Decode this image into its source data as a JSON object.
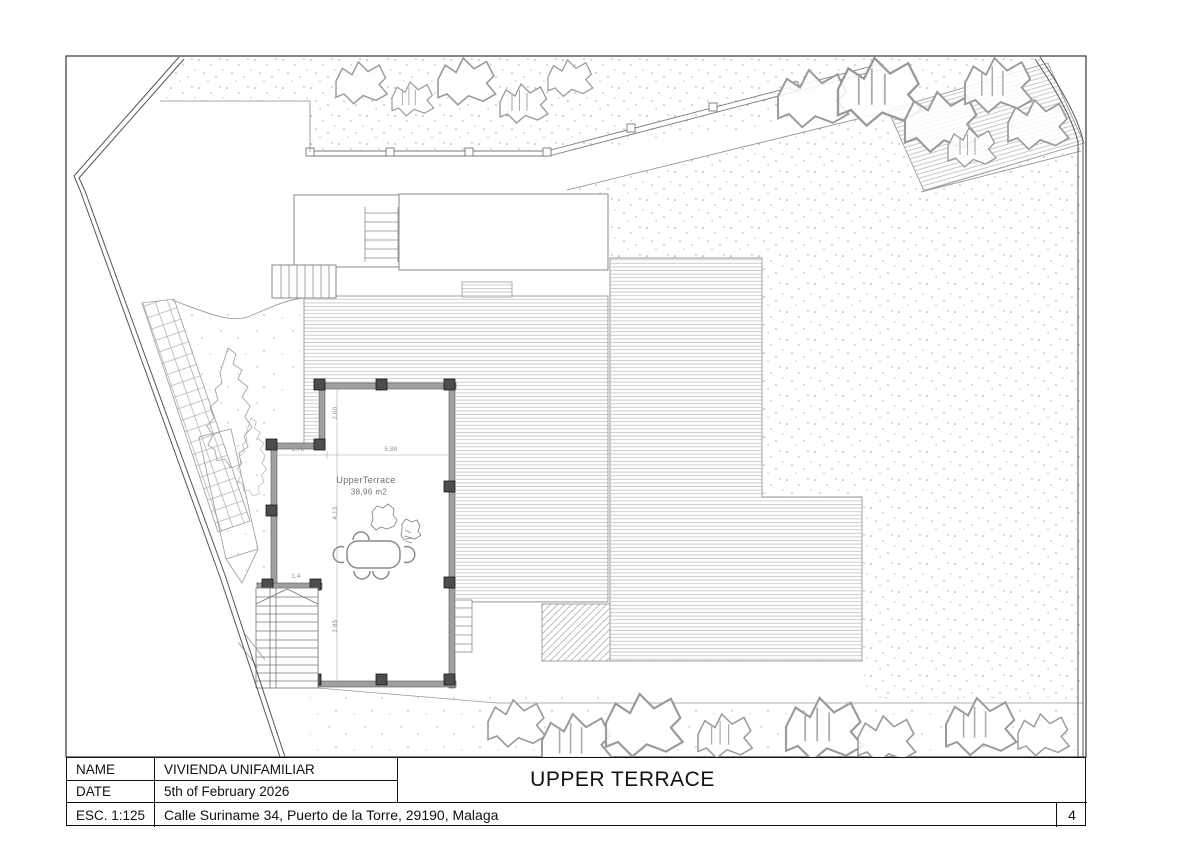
{
  "sheet": {
    "type": "architectural-floor-plan",
    "sheet_title": "UPPER TERRACE",
    "page_number": "4"
  },
  "title_block": {
    "name_label": "NAME",
    "name_value": "VIVIENDA UNIFAMILIAR",
    "date_label": "DATE",
    "date_value": "5th of February 2026",
    "scale_label": "ESC. 1:125",
    "address": "Calle Suriname 34, Puerto de la Torre, 29190, Malaga"
  },
  "plan": {
    "room_label": "UpperTerrace",
    "room_area": "38,96 m2",
    "dimensions": [
      {
        "label": "2,60",
        "orientation": "vertical"
      },
      {
        "label": "1,76",
        "orientation": "horizontal"
      },
      {
        "label": "5,88",
        "orientation": "horizontal"
      },
      {
        "label": "4,13",
        "orientation": "vertical"
      },
      {
        "label": "1,4",
        "orientation": "horizontal"
      },
      {
        "label": "2,85",
        "orientation": "vertical"
      }
    ],
    "features": [
      "terrace with pillars",
      "dining table with six chairs",
      "two staircases",
      "timber deck areas",
      "gravel areas",
      "tiled garden path",
      "trees and shrubs",
      "site boundary",
      "fence"
    ]
  },
  "colors": {
    "paper": "#ffffff",
    "line_dark": "#444444",
    "line_light": "#999999",
    "wall_fill": "#a0a0a0",
    "pillar_fill": "#4d4d4d",
    "deck_stripe": "#c8c8c8",
    "stipple_dot": "#9a9a9a"
  }
}
